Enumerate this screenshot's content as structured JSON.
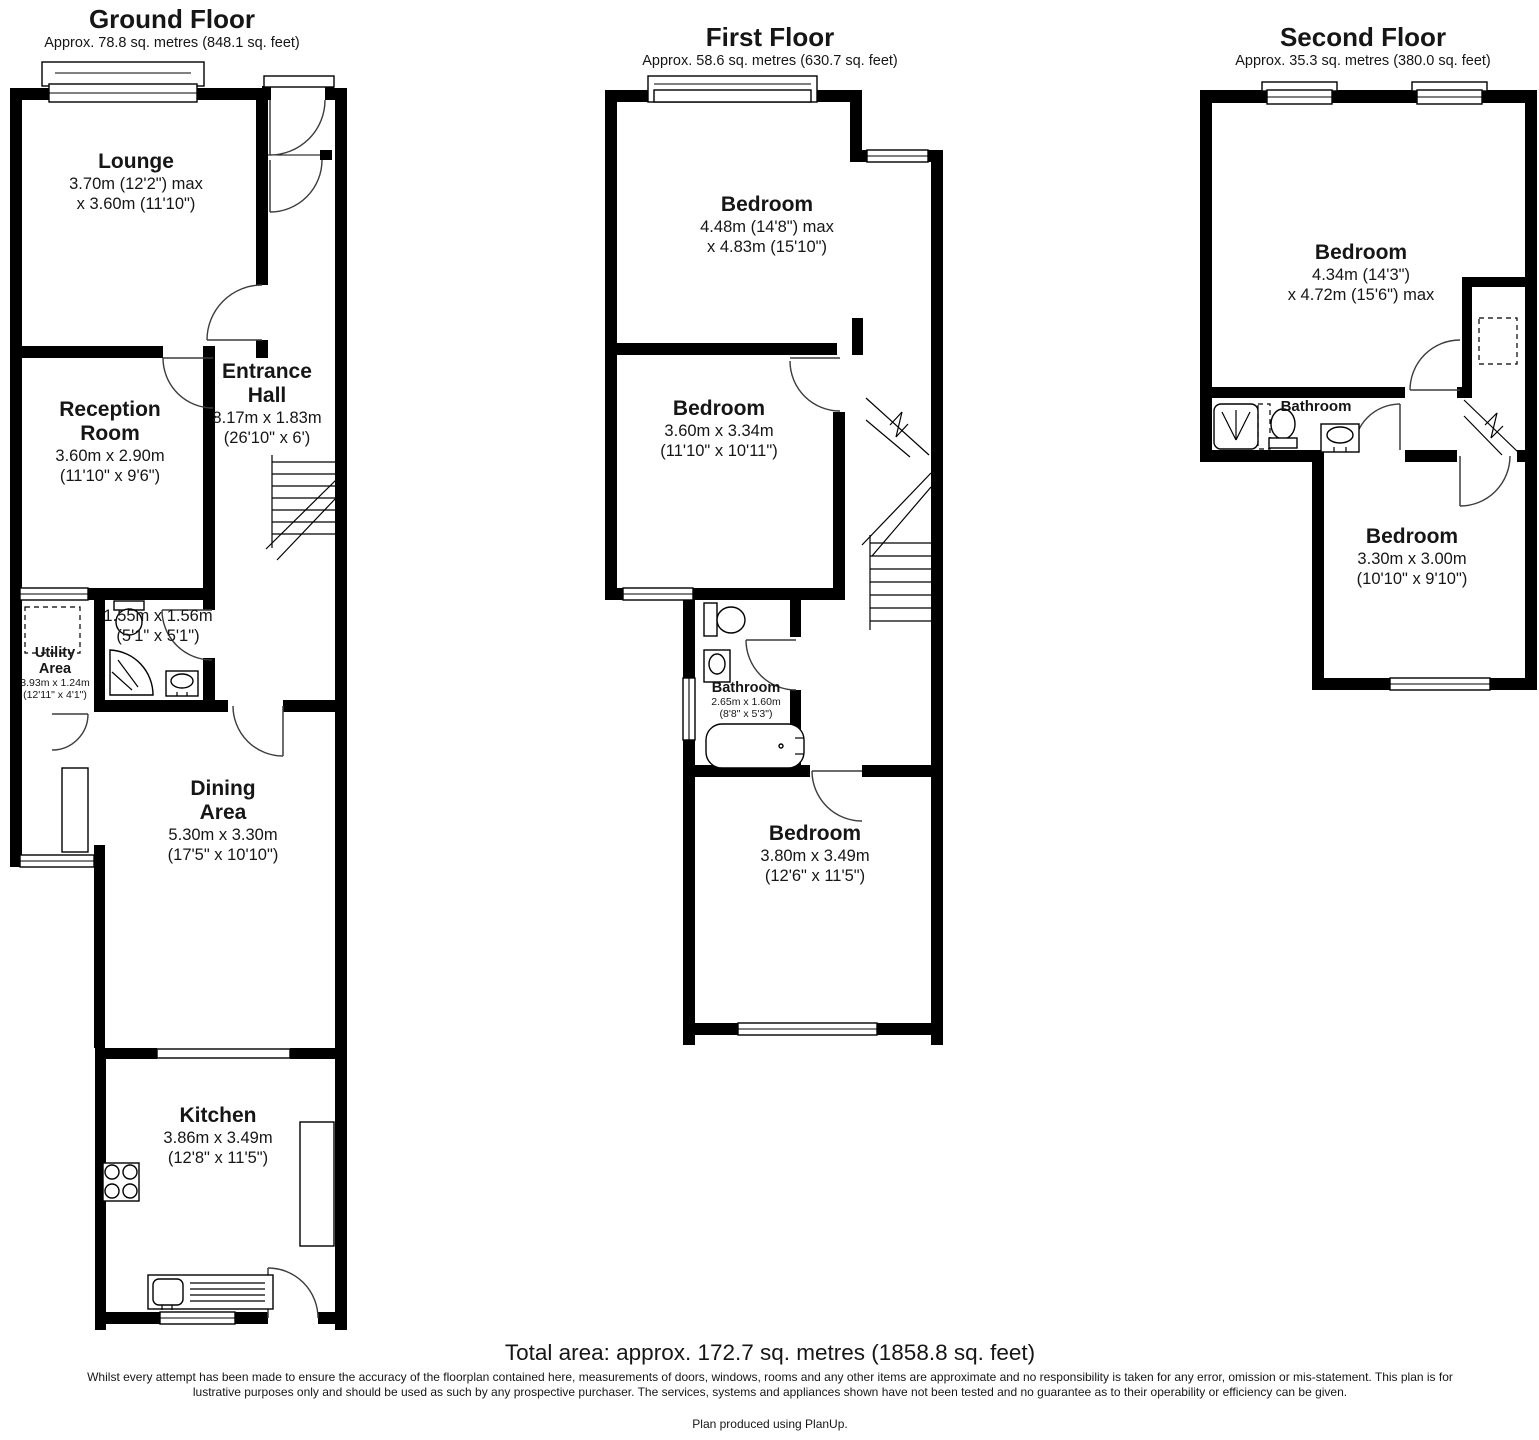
{
  "floors": [
    {
      "id": "ground",
      "title": "Ground Floor",
      "area": "Approx. 78.8 sq. metres (848.1 sq. feet)",
      "rooms": [
        {
          "name": "Lounge",
          "dims": [
            "3.70m (12'2\") max",
            "x 3.60m (11'10\")"
          ]
        },
        {
          "name": "Reception Room",
          "dims": [
            "3.60m x 2.90m",
            "(11'10\" x 9'6\")"
          ]
        },
        {
          "name": "Entrance Hall",
          "dims": [
            "8.17m x 1.83m",
            "(26'10\" x 6')"
          ]
        },
        {
          "name": "Utility Area",
          "dims": [
            "3.93m x 1.24m",
            "(12'11\" x 4'1\")"
          ]
        },
        {
          "name": "",
          "dims": [
            "1.55m x 1.56m",
            "(5'1\" x 5'1\")"
          ]
        },
        {
          "name": "Dining Area",
          "dims": [
            "5.30m x 3.30m",
            "(17'5\" x 10'10\")"
          ]
        },
        {
          "name": "Kitchen",
          "dims": [
            "3.86m x 3.49m",
            "(12'8\" x 11'5\")"
          ]
        }
      ]
    },
    {
      "id": "first",
      "title": "First Floor",
      "area": "Approx. 58.6 sq. metres (630.7 sq. feet)",
      "rooms": [
        {
          "name": "Bedroom",
          "dims": [
            "4.48m (14'8\") max",
            "x 4.83m (15'10\")"
          ]
        },
        {
          "name": "Bedroom",
          "dims": [
            "3.60m x 3.34m",
            "(11'10\" x 10'11\")"
          ]
        },
        {
          "name": "Bathroom",
          "dims": [
            "2.65m x 1.60m",
            "(8'8\" x 5'3\")"
          ]
        },
        {
          "name": "Bedroom",
          "dims": [
            "3.80m x 3.49m",
            "(12'6\" x 11'5\")"
          ]
        }
      ]
    },
    {
      "id": "second",
      "title": "Second Floor",
      "area": "Approx. 35.3 sq. metres (380.0 sq. feet)",
      "rooms": [
        {
          "name": "Bedroom",
          "dims": [
            "4.34m (14'3\")",
            "x 4.72m (15'6\") max"
          ]
        },
        {
          "name": "Bathroom",
          "dims": []
        },
        {
          "name": "Bedroom",
          "dims": [
            "3.30m x 3.00m",
            "(10'10\" x 9'10\")"
          ]
        }
      ]
    }
  ],
  "footer": {
    "total": "Total area: approx. 172.7 sq. metres (1858.8 sq. feet)",
    "disclaimer": "Whilst every attempt has been made to ensure the accuracy of the floorplan contained here, measurements of doors, windows, rooms and any other items are approximate and no responsibility is taken for any error, omission or mis-statement. This plan is for lustrative purposes only and should be used as such by any prospective purchaser. The services, systems and appliances shown have not been tested and no guarantee as to their operability or efficiency can be given.",
    "credit": "Plan produced using PlanUp."
  }
}
